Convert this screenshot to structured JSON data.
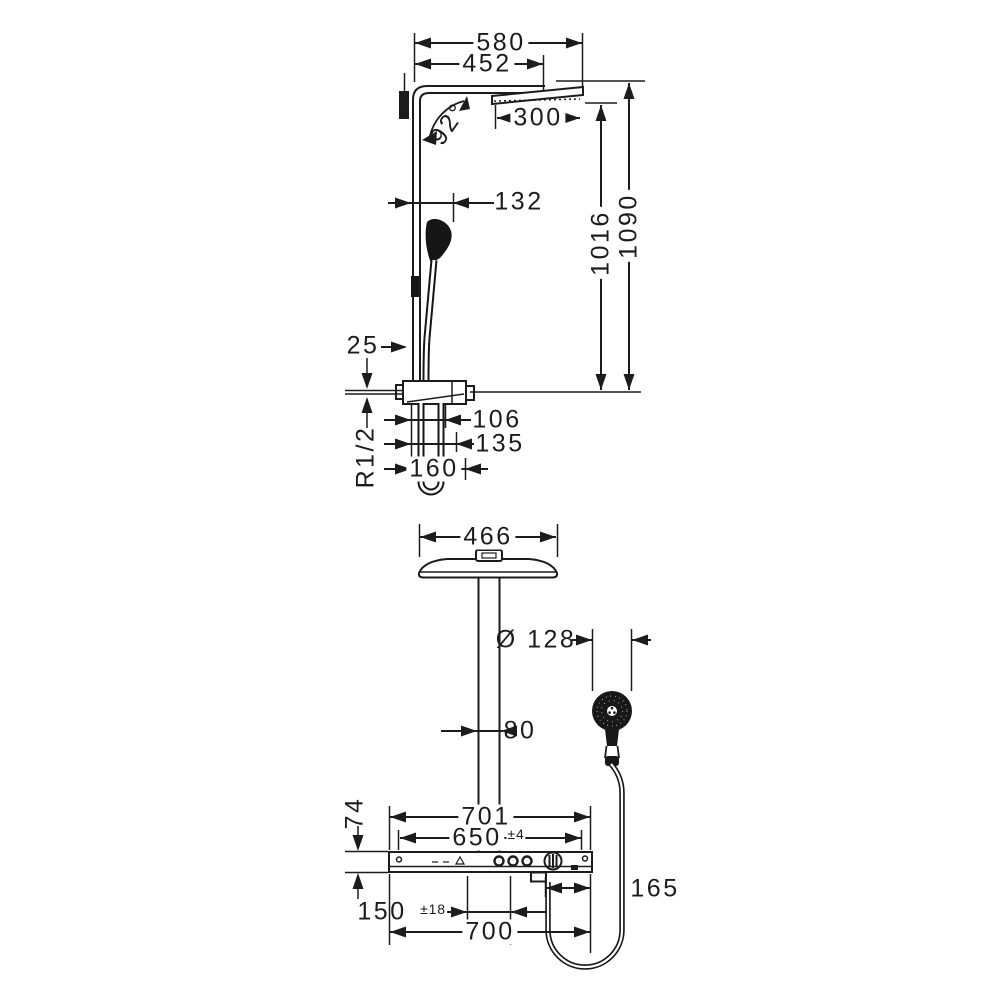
{
  "drawing": {
    "type": "technical-dimension-drawing",
    "subject": "shower pipe with overhead shower, hand shower and thermostat bar",
    "line_color": "#1c1c1c",
    "views": {
      "side_view": {
        "labels": {
          "width_overall": "580",
          "arm_projection": "452",
          "arm_angle": "92°",
          "overhead_shower_size": "300",
          "handshower_offset": "132",
          "height_to_overhead": "1016",
          "height_overall": "1090",
          "wall_clearance": "25",
          "outlet_offset_1": "106",
          "outlet_offset_2": "135",
          "hose_bend": "160",
          "connection_thread": "R1/2"
        }
      },
      "front_view": {
        "labels": {
          "overhead_width": "466",
          "handshower_diameter": "Ø 128",
          "pipe_width": "80",
          "bar_length_overall": "701",
          "fixing_distance": "650",
          "fixing_tolerance": "±4",
          "bar_height": "74",
          "outlet_to_edge": "165",
          "supply_distance": "150",
          "supply_tolerance": "±18",
          "bar_length": "700"
        }
      }
    }
  }
}
